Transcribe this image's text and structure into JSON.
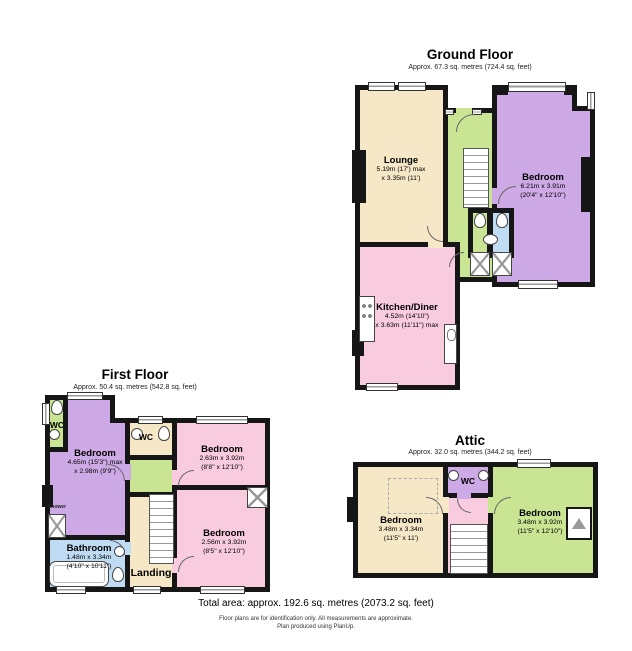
{
  "colors": {
    "wall": "#161616",
    "cream": "#F6E7C6",
    "green": "#C9E593",
    "purple": "#CDA9E5",
    "pink": "#F9CBDE",
    "blue": "#BFDCF4"
  },
  "ground": {
    "title": "Ground Floor",
    "subtitle": "Approx. 67.3 sq. metres (724.4 sq. feet)",
    "lounge": {
      "name": "Lounge",
      "dim1": "5.19m (17') max",
      "dim2": "x 3.35m (11')"
    },
    "bedroom": {
      "name": "Bedroom",
      "dim1": "6.21m x 3.91m",
      "dim2": "(20'4\" x 12'10\")"
    },
    "kitchen": {
      "name": "Kitchen/Diner",
      "dim1": "4.52m (14'10\")",
      "dim2": "x 3.63m (11'11\") max"
    }
  },
  "first": {
    "title": "First Floor",
    "subtitle": "Approx. 50.4 sq. metres (542.8 sq. feet)",
    "bedroom_left": {
      "name": "Bedroom",
      "dim1": "4.65m (15'3\") max",
      "dim2": "x 2.98m (9'9\")"
    },
    "bedroom_top_right": {
      "name": "Bedroom",
      "dim1": "2.63m x 3.92m",
      "dim2": "(8'8\" x 12'10\")"
    },
    "bedroom_bottom_right": {
      "name": "Bedroom",
      "dim1": "2.56m x 3.92m",
      "dim2": "(8'5\" x 12'10\")"
    },
    "bathroom": {
      "name": "Bathroom",
      "dim1": "1.48m x 3.34m",
      "dim2": "(4'10\" x 10'11\")"
    },
    "landing": "Landing",
    "wc_left": "WC",
    "wc_mid": "WC",
    "shower": "Shower"
  },
  "attic": {
    "title": "Attic",
    "subtitle": "Approx. 32.0 sq. metres (344.2 sq. feet)",
    "bedroom_left": {
      "name": "Bedroom",
      "dim1": "3.48m x 3.34m",
      "dim2": "(11'5\" x 11')"
    },
    "bedroom_right": {
      "name": "Bedroom",
      "dim1": "3.48m x 3.92m",
      "dim2": "(11'5\" x 12'10\")"
    },
    "wc": "WC"
  },
  "footer": {
    "total_area": "Total area: approx. 192.6 sq. metres (2073.2 sq. feet)",
    "disclaimer": "Floor plans are for identification only. All measurements are approximate.",
    "produced": "Plan produced using PlanUp."
  }
}
